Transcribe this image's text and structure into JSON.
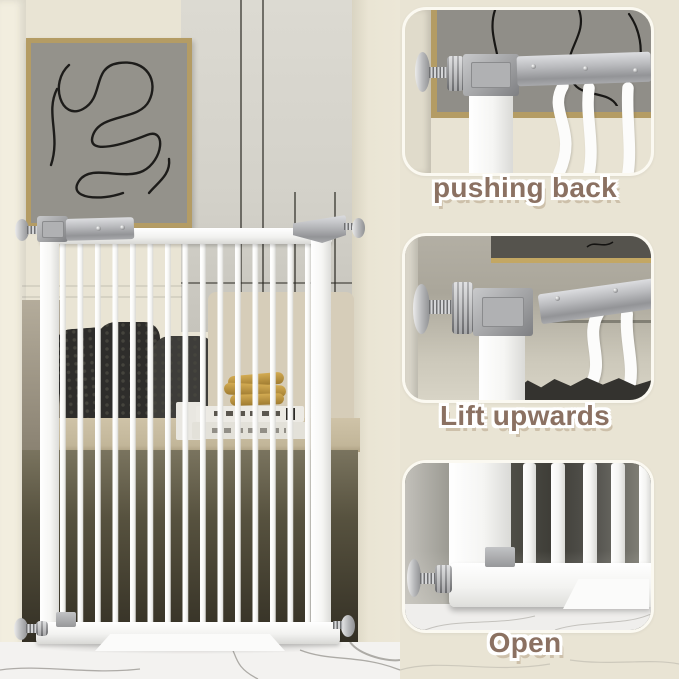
{
  "image_type": "product-instruction-photo",
  "subject": "white metal pressure-mounted safety gate in living room",
  "panels": [
    {
      "caption": "pushing back"
    },
    {
      "caption": "Lift upwards"
    },
    {
      "caption": "Open"
    }
  ],
  "colors": {
    "background_cream": "#e9e4d4",
    "caption_text": "#8b7162",
    "caption_outline": "#ffffff",
    "gate_white": "#fbfbfa",
    "hardware_silver": "#a9aaac",
    "picture_frame_gold": "#b49c64",
    "marble_floor": "#f3f2f0",
    "couch_pillow_dark": "#2e2d2b"
  }
}
